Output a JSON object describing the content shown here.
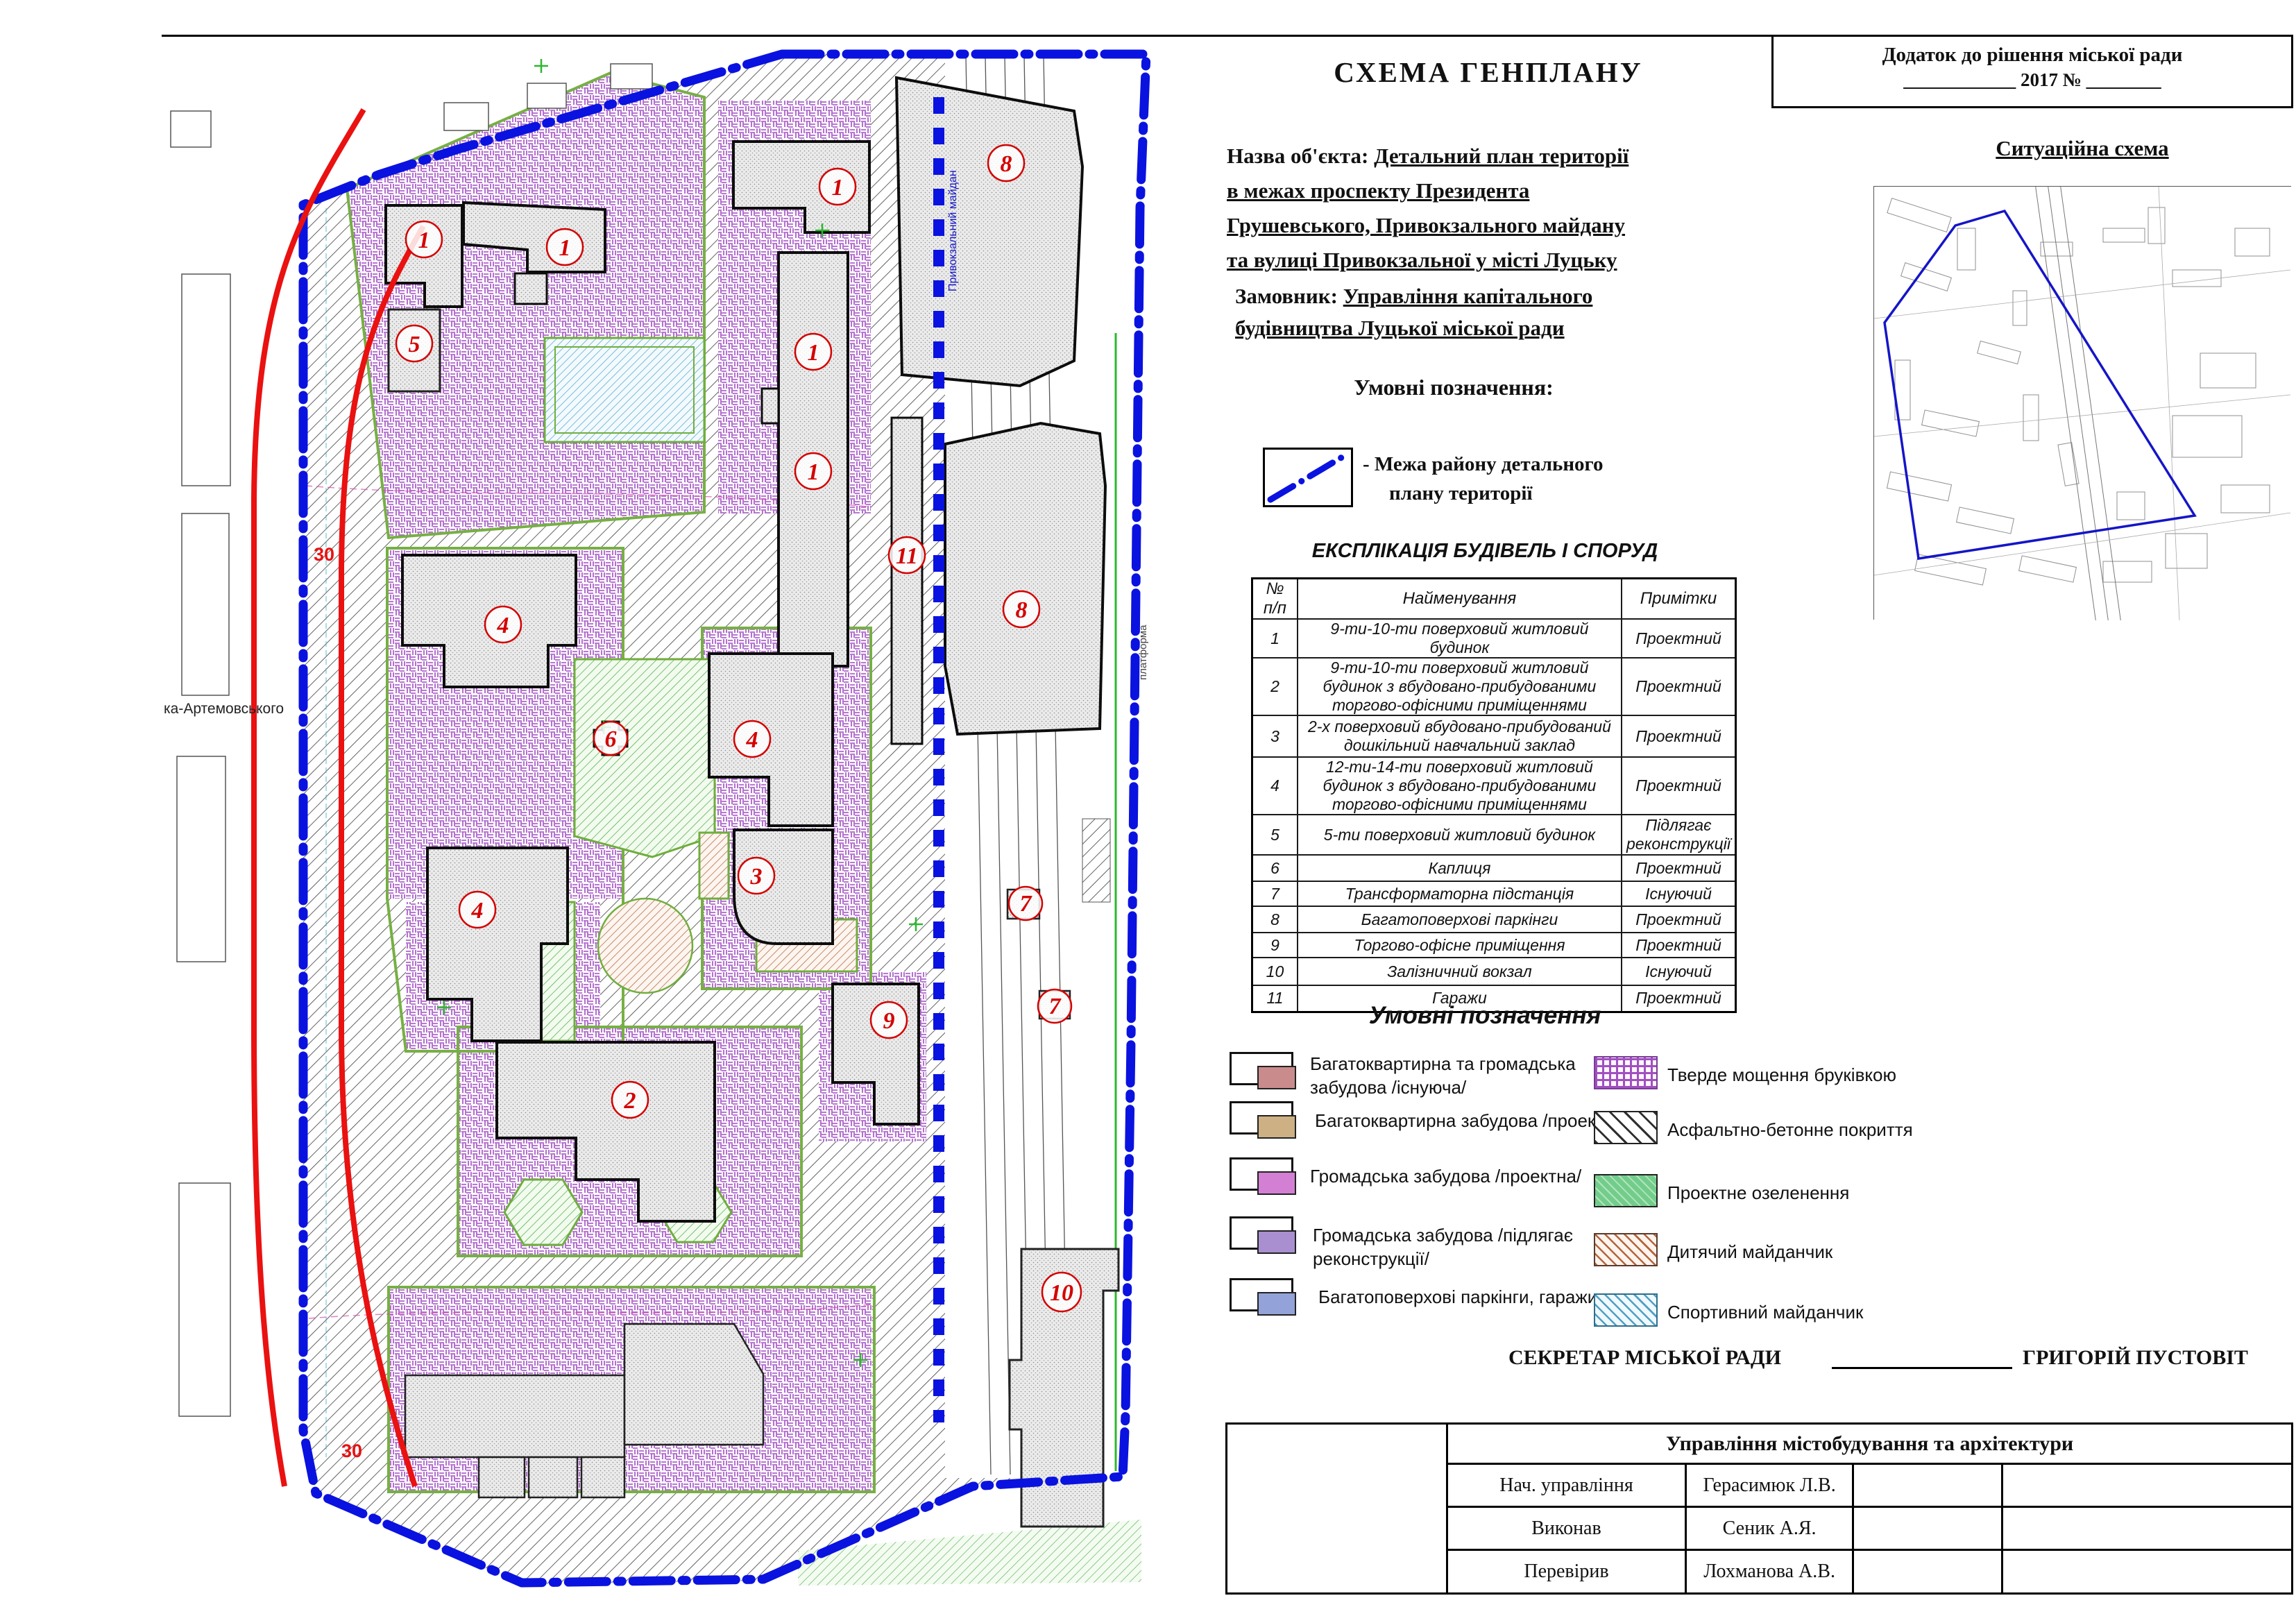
{
  "header": {
    "dodatok_line1": "Додаток до рішення міської ради",
    "dodatok_line2": "____________ 2017  №  ________",
    "title": "СХЕМА ГЕНПЛАНУ",
    "object_label": "Назва об'єкта:",
    "object_line1": "Детальний план території",
    "object_line2": "в межах проспекту Президента",
    "object_line3": "Грушевського, Привокзального майдану",
    "object_line4": "та вулиці Привокзальної у місті Луцьку",
    "customer_label": "Замовник:",
    "customer_line1": "Управління капітального",
    "customer_line2": "будівництва Луцької міської ради",
    "situational_title": "Ситуаційна схема",
    "year": "2017"
  },
  "legend1": {
    "title": "Умовні позначення:",
    "boundary_line1": "-  Межа району детального",
    "boundary_line2": "плану території",
    "boundary_color": "#0a12e0"
  },
  "explication": {
    "title": "ЕКСПЛІКАЦІЯ БУДІВЕЛЬ І СПОРУД",
    "col_num_line1": "№",
    "col_num_line2": "п/п",
    "col_name": "Найменування",
    "col_note": "Примітки",
    "rows": [
      {
        "num": "1",
        "name": "9-ти-10-ти поверховий житловий будинок",
        "note": "Проектний"
      },
      {
        "num": "2",
        "name": "9-ти-10-ти поверховий житловий будинок з вбудовано-прибудованими торгово-офісними приміщеннями",
        "note": "Проектний"
      },
      {
        "num": "3",
        "name": "2-х поверховий вбудовано-прибудований дошкільний навчальний заклад",
        "note": "Проектний"
      },
      {
        "num": "4",
        "name": "12-ти-14-ти поверховий житловий будинок з вбудовано-прибудованими торгово-офісними приміщеннями",
        "note": "Проектний"
      },
      {
        "num": "5",
        "name": "5-ти поверховий житловий будинок",
        "note": "Підлягає реконструкції"
      },
      {
        "num": "6",
        "name": "Каплиця",
        "note": "Проектний"
      },
      {
        "num": "7",
        "name": "Трансформаторна підстанція",
        "note": "Існуючий"
      },
      {
        "num": "8",
        "name": "Багатоповерхові паркінги",
        "note": "Проектний"
      },
      {
        "num": "9",
        "name": "Торгово-офісне приміщення",
        "note": "Проектний"
      },
      {
        "num": "10",
        "name": "Залізничний вокзал",
        "note": "Існуючий"
      },
      {
        "num": "11",
        "name": "Гаражи",
        "note": "Проектний"
      }
    ]
  },
  "legend2": {
    "title": "Умовні позначення",
    "left": [
      {
        "label1": "Багатоквартирна   та громадська",
        "label2": "забудова /існуюча/",
        "color": "#c98b8b"
      },
      {
        "label1": "Багатоквартирна забудова /проектна/",
        "label2": "",
        "color": "#cdb184"
      },
      {
        "label1": "Громадська забудова /проектна/",
        "label2": "",
        "color": "#d37fd3"
      },
      {
        "label1": "Громадська забудова /підлягає реконструкції/",
        "label2": "",
        "color": "#a98fd0"
      },
      {
        "label1": "Багатоповерхові паркінги, гаражи",
        "label2": "",
        "color": "#93a2d8"
      }
    ],
    "right": [
      {
        "label": "Тверде мощення бруківкою",
        "color": "#a050c0"
      },
      {
        "label": "Асфальтно-бетонне покриття",
        "color": "#2e2e2e"
      },
      {
        "label": "Проектне озеленення",
        "color": "#72cd8a"
      },
      {
        "label": "Дитячий майданчик",
        "color": "#b5643c"
      },
      {
        "label": "Спортивний майданчик",
        "color": "#4f9fc4"
      }
    ]
  },
  "signature": {
    "secretary_label": "СЕКРЕТАР МІСЬКОЇ РАДИ",
    "secretary_name": "ГРИГОРІЙ ПУСТОВІТ",
    "table_title": "Управління містобудування та архітектури",
    "rows": [
      {
        "role": "Нач. управління",
        "name": "Герасимюк Л.В."
      },
      {
        "role": "Виконав",
        "name": "Сеник А.Я."
      },
      {
        "role": "Перевірив",
        "name": "Лохманова А.В."
      }
    ]
  },
  "map": {
    "markers": [
      "1",
      "1",
      "1",
      "1",
      "1",
      "5",
      "8",
      "8",
      "11",
      "4",
      "4",
      "4",
      "6",
      "3",
      "2",
      "9",
      "7",
      "7",
      "10"
    ],
    "red_label_1": "30",
    "red_label_2": "30",
    "street_label": "ка-Артемовського",
    "rail_label": "Привокзальний майдан",
    "platform_label": "платформа",
    "marker_color": "#d40000",
    "boundary_color": "#0a12e0",
    "redline_color": "#ea1111"
  }
}
